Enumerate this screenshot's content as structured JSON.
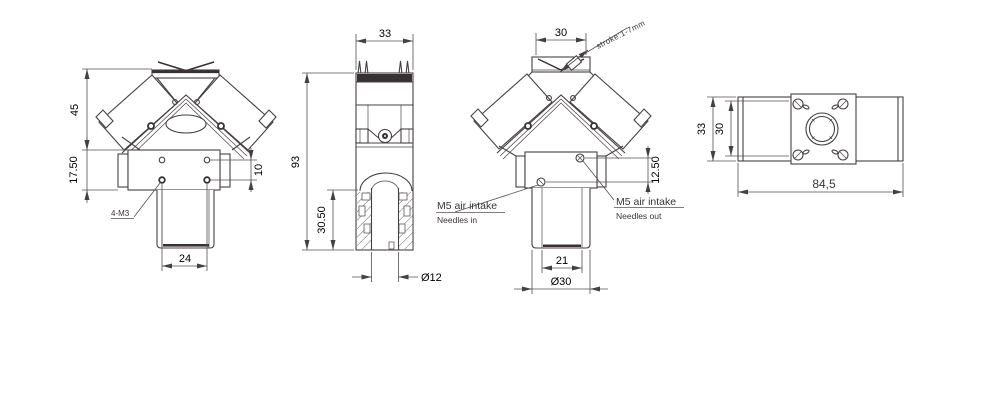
{
  "drawing": {
    "title": "pneumatic-gripper-dimension-drawing",
    "front_view": {
      "dim_head_height": "45",
      "dim_body_height": "17.50",
      "dim_hole_spacing": "10",
      "dim_base_width": "24",
      "thread_callout": "4-M3"
    },
    "side_view": {
      "dim_width": "33",
      "dim_total_height": "93",
      "dim_bore_depth": "30.50",
      "dim_bore_diameter": "Ø12"
    },
    "rear_view": {
      "dim_width": "30",
      "stroke_callout": "stroke:1-7mm",
      "dim_port_offset": "12.50",
      "dim_neck_width": "21",
      "dim_base_diameter": "Ø30",
      "port_left_title": "M5 air intake",
      "port_left_subtitle": "Needles in",
      "port_right_title": "M5 air intake",
      "port_right_subtitle": "Needles out"
    },
    "top_view": {
      "dim_outer_height": "33",
      "dim_inner_height": "30",
      "dim_length": "84,5"
    },
    "colors": {
      "line": "#454042",
      "dark_fill": "#383133",
      "dimension": "#55504e",
      "background": "#ffffff"
    }
  }
}
